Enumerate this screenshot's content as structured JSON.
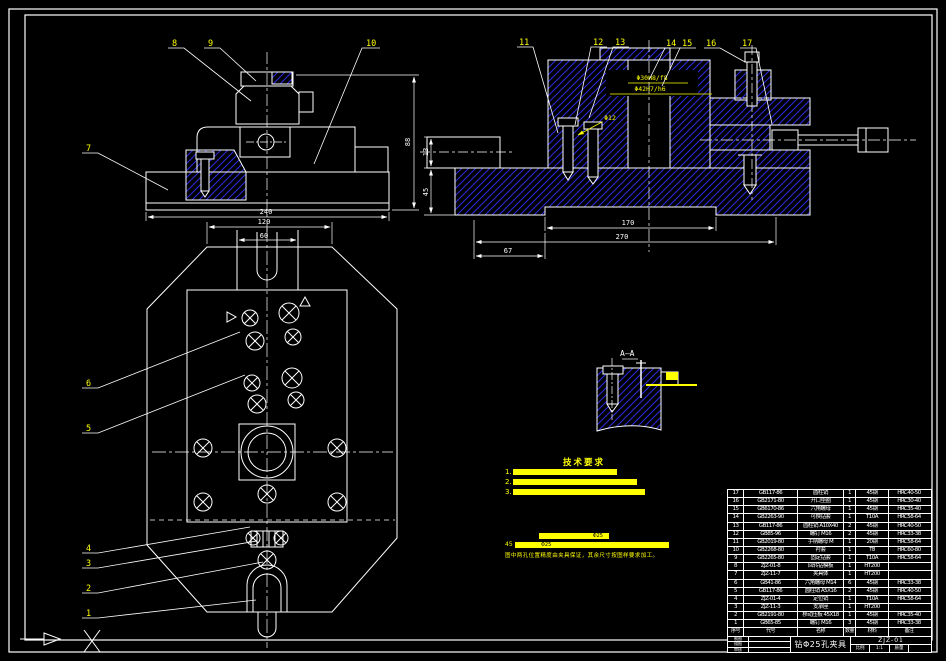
{
  "colors": {
    "line": "#ffffff",
    "hatch_blue": "#2a2ad9",
    "accent_yellow": "#ffff00"
  },
  "views": {
    "front": {
      "balloons": [
        "7",
        "8",
        "9",
        "10"
      ],
      "dims": {
        "w": "240",
        "h": "88"
      }
    },
    "plan": {
      "balloons": [
        "6",
        "5",
        "4",
        "3",
        "2",
        "1"
      ],
      "dims": {
        "w": "120",
        "slot": "60"
      }
    },
    "section": {
      "balloons": [
        "11",
        "12",
        "13",
        "14",
        "15",
        "16",
        "17"
      ],
      "fits": {
        "a": "Φ30H8/f8",
        "b": "Φ42H7/h6",
        "c": "Φ12"
      },
      "dims": {
        "boss": "170",
        "base": "270",
        "left": "67",
        "step": "13",
        "height": "45"
      }
    },
    "detail": {
      "label": "A—A"
    }
  },
  "tech_req": {
    "heading": "技术要求",
    "items": [
      {
        "no": "1.",
        "text": "装配前所有零件均须清洗干净"
      },
      {
        "no": "2.",
        "text": "钻套轴线对定位底面的垂直度不大于0.02"
      },
      {
        "no": "3.",
        "text": "各定位元件磨损后应及时更换以保证加工精度"
      }
    ],
    "callouts": [
      {
        "label": "",
        "text": "Φ25"
      },
      {
        "label": "45",
        "text": "Φ25"
      }
    ],
    "note": "图中两孔位置精度由夹具保证，其余尺寸按图样要求加工。"
  },
  "bom": {
    "headers": {
      "no": "序号",
      "code": "代号",
      "name": "名称",
      "qty": "数量",
      "material": "材料",
      "note": "备注"
    },
    "rows": [
      {
        "no": "17",
        "code": "GB117-86",
        "name": "圆柱销",
        "qty": "1",
        "material": "45钢",
        "note": "HRC40-50"
      },
      {
        "no": "16",
        "code": "GB2171-80",
        "name": "开口垫圈",
        "qty": "1",
        "material": "45钢",
        "note": "HRC30-40"
      },
      {
        "no": "15",
        "code": "GB6170-86",
        "name": "六角螺母",
        "qty": "1",
        "material": "45钢",
        "note": "HRC35-40"
      },
      {
        "no": "14",
        "code": "GB2263-90",
        "name": "可换钻套",
        "qty": "1",
        "material": "T10A",
        "note": "HRC58-64"
      },
      {
        "no": "13",
        "code": "GB117-86",
        "name": "圆柱销 A10X40",
        "qty": "2",
        "material": "45钢",
        "note": "HRC40-50"
      },
      {
        "no": "12",
        "code": "GB85-96",
        "name": "螺钉 M16",
        "qty": "2",
        "material": "45钢",
        "note": "HRC33-38"
      },
      {
        "no": "11",
        "code": "GB2019-80",
        "name": "手柄螺母 M",
        "qty": "1",
        "material": "20钢",
        "note": "HRC58-64"
      },
      {
        "no": "10",
        "code": "GB2268-80",
        "name": "衬套",
        "qty": "1",
        "material": "T8",
        "note": "HRC60-80"
      },
      {
        "no": "9",
        "code": "GB2265-80",
        "name": "固定钻套",
        "qty": "1",
        "material": "T10A",
        "note": "HRC58-64"
      },
      {
        "no": "8",
        "code": "ZJZ-01-8",
        "name": "回转钻模板",
        "qty": "1",
        "material": "HT200",
        "note": ""
      },
      {
        "no": "7",
        "code": "ZJZ-11-7",
        "name": "夹具体",
        "qty": "1",
        "material": "HT200",
        "note": ""
      },
      {
        "no": "6",
        "code": "GB41-86",
        "name": "六角螺母 M14",
        "qty": "6",
        "material": "45钢",
        "note": "HRC33-38"
      },
      {
        "no": "5",
        "code": "GB117-86",
        "name": "圆柱销 A5X16",
        "qty": "2",
        "material": "45钢",
        "note": "HRC40-50"
      },
      {
        "no": "4",
        "code": "ZJZ-01-4",
        "name": "定位销",
        "qty": "1",
        "material": "T10A",
        "note": "HRC58-64"
      },
      {
        "no": "3",
        "code": "ZJZ-11-3",
        "name": "支承座",
        "qty": "1",
        "material": "HT200",
        "note": ""
      },
      {
        "no": "2",
        "code": "GB2191-80",
        "name": "移动压板 45X18",
        "qty": "1",
        "material": "45钢",
        "note": "HRC35-40"
      },
      {
        "no": "1",
        "code": "GB65-85",
        "name": "螺钉 M16",
        "qty": "3",
        "material": "45钢",
        "note": "HRC33-38"
      }
    ]
  },
  "title_block": {
    "title": "钻Φ25孔夹具",
    "dwg_no": "ZJZ-01",
    "scale_label": "比例",
    "scale": "1:1",
    "mass_label": "质量",
    "left_rows": [
      {
        "label": "制图"
      },
      {
        "label": "描图"
      },
      {
        "label": "审核"
      }
    ]
  }
}
